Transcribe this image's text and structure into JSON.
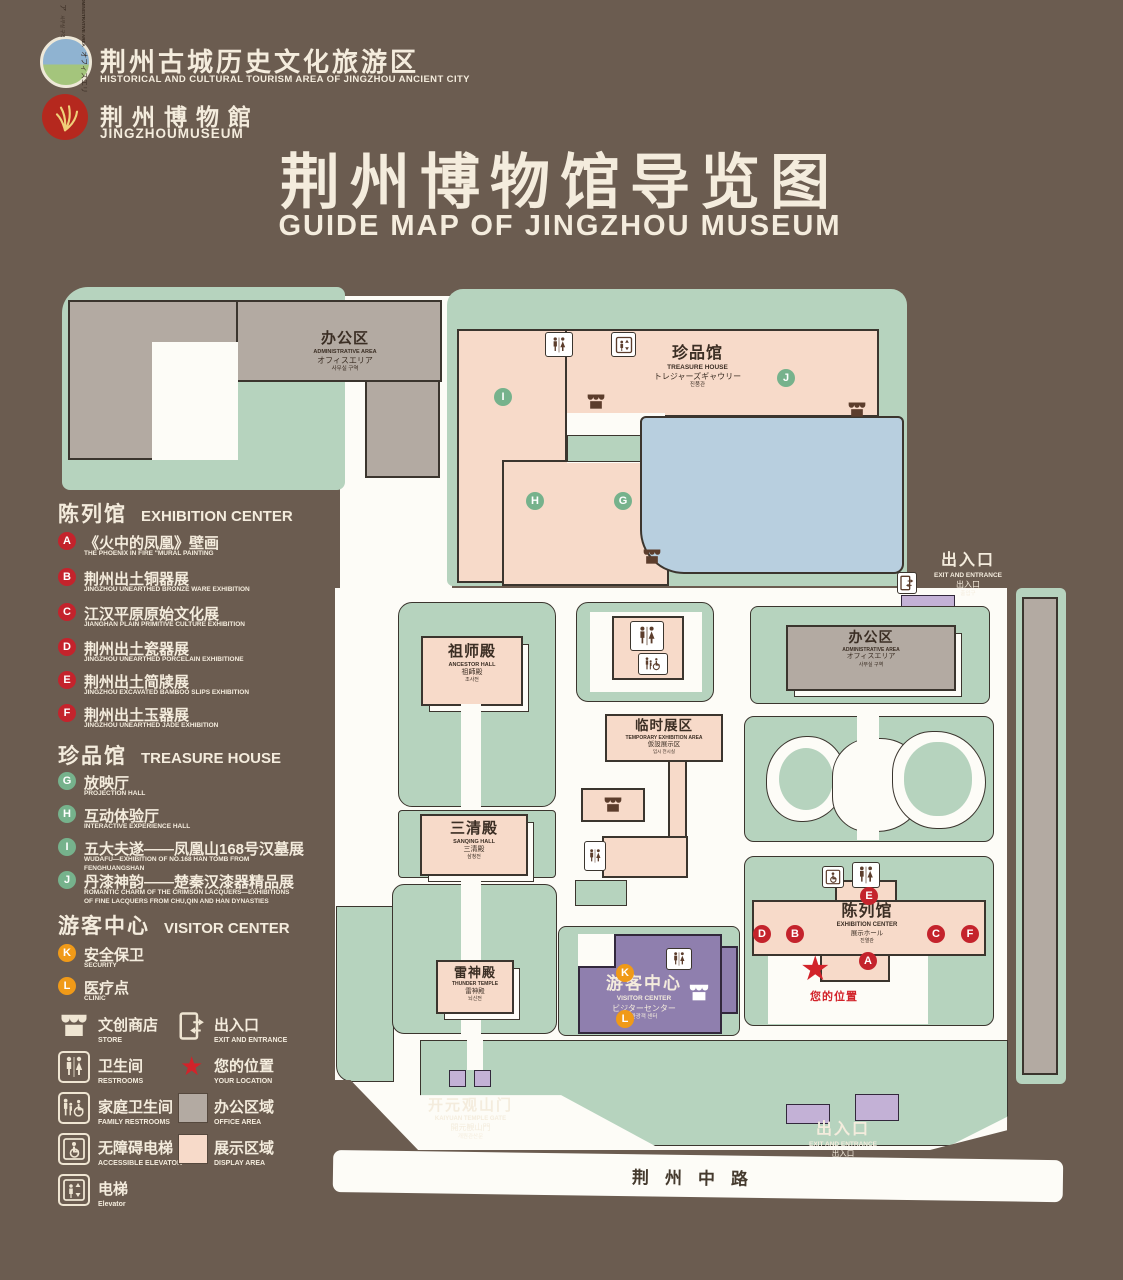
{
  "header": {
    "org": {
      "title": "荆州古城历史文化旅游区",
      "subtitle": "HISTORICAL AND CULTURAL TOURISM AREA OF JINGZHOU ANCIENT CITY"
    },
    "museum": {
      "title": "荆州博物館",
      "subtitle": "JINGZHOUMUSEUM"
    },
    "title": "荆州博物馆导览图",
    "subtitle": "GUIDE MAP OF JINGZHOU MUSEUM"
  },
  "legend": {
    "exhibition": {
      "cn": "陈列馆",
      "en": "EXHIBITION CENTER",
      "items": [
        {
          "id": "A",
          "cn": "《火中的凤凰》壁画",
          "en": "THE PHOENIX IN FIRE \"MURAL PAINTING",
          "floor": "1F"
        },
        {
          "id": "B",
          "cn": "荆州出土铜器展",
          "en": "JINGZHOU UNEARTHED BRONZE WARE EXHIBITION",
          "floor": "1F"
        },
        {
          "id": "C",
          "cn": "江汉平原原始文化展",
          "en": "JIANGHAN PLAIN PRIMITIVE CULTURE EXHIBITION",
          "floor": "1F"
        },
        {
          "id": "D",
          "cn": "荆州出土瓷器展",
          "en": "JINGZHOU UNEARTHED PORCELAIN EXHIBITIONE",
          "floor": "2F"
        },
        {
          "id": "E",
          "cn": "荆州出土简牍展",
          "en": "JINGZHOU EXCAVATED BAMBOO SLIPS EXHIBITION",
          "floor": "2F"
        },
        {
          "id": "F",
          "cn": "荆州出土玉器展",
          "en": "JINGZHOU UNEARTHED JADE EXHIBITION",
          "floor": "2F"
        }
      ]
    },
    "treasure": {
      "cn": "珍品馆",
      "en": "TREASURE HOUSE",
      "items": [
        {
          "id": "G",
          "cn": "放映厅",
          "en": "PROJECTION HALL",
          "floor": "1F"
        },
        {
          "id": "H",
          "cn": "互动体验厅",
          "en": "INTERACTIVE EXPERIENCE HALL",
          "floor": "1F"
        },
        {
          "id": "I",
          "cn": "五大夫遂——凤凰山168号汉墓展",
          "en": "WUDAFU—EXHIBITION OF NO.168 HAN TOMB FROM FENGHUANGSHAN",
          "floor": "2F"
        },
        {
          "id": "J",
          "cn": "丹漆神韵——楚秦汉漆器精品展",
          "en": "ROMANTIC CHARM OF THE CRIMSON LACQUERS—EXHIBITIONS OF FINE LACQUERS FROM CHU,QIN AND HAN DYNASTIES",
          "floor": "1-2F"
        }
      ]
    },
    "visitor": {
      "cn": "游客中心",
      "en": "VISITOR CENTER",
      "items": [
        {
          "id": "K",
          "cn": "安全保卫",
          "en": "SECURITY",
          "floor": "1F"
        },
        {
          "id": "L",
          "cn": "医疗点",
          "en": "CLINIC",
          "floor": "1F"
        }
      ]
    },
    "symbols": [
      {
        "icon": "store-icon",
        "cn": "文创商店",
        "en": "STORE"
      },
      {
        "icon": "exit-icon",
        "cn": "出入口",
        "en": "EXIT AND ENTRANCE"
      },
      {
        "icon": "restroom-icon",
        "cn": "卫生间",
        "en": "RESTROOMS"
      },
      {
        "icon": "location-icon",
        "cn": "您的位置",
        "en": "YOUR LOCATION"
      },
      {
        "icon": "family-restroom-icon",
        "cn": "家庭卫生间",
        "en": "FAMILY RESTROOMS"
      },
      {
        "icon": "office-swatch",
        "cn": "办公区域",
        "en": "OFFICE AREA"
      },
      {
        "icon": "accessible-elevator-icon",
        "cn": "无障碍电梯",
        "en": "ACCESSIBLE ELEVATOR"
      },
      {
        "icon": "display-swatch",
        "cn": "展示区域",
        "en": "DISPLAY AREA"
      },
      {
        "icon": "elevator-icon",
        "cn": "电梯",
        "en": "Elevator"
      }
    ]
  },
  "map": {
    "admin_nw": {
      "cn": "办公区",
      "en": "ADMINISTRATIVE AREA",
      "jp": "オフィスエリア",
      "kr": "사무실 구역"
    },
    "treasure_house": {
      "cn": "珍品馆",
      "en": "TREASURE HOUSE",
      "jp": "トレジャーズギャウリー",
      "kr": "진품관"
    },
    "exit_ne": {
      "cn": "出入口",
      "en": "EXIT AND ENTRANCE",
      "jp": "出入口",
      "kr": "출입구"
    },
    "admin_e": {
      "cn": "办公区",
      "en": "ADMINISTRATIVE AREA",
      "jp": "オフィスエリア",
      "kr": "사무실 구역"
    },
    "admin_strip": {
      "cn": "办公区",
      "en": "ADMINISTRATIVE AREA",
      "jp": "オフィスエリア",
      "kr": "사무실 구역"
    },
    "ancestor_hall": {
      "cn": "祖师殿",
      "en": "ANCESTOR HALL",
      "jp": "祖師殿",
      "kr": "조사전"
    },
    "sanqing_hall": {
      "cn": "三清殿",
      "en": "SANQING HALL",
      "jp": "三清殿",
      "kr": "삼청전"
    },
    "temporary_area": {
      "cn": "临时展区",
      "en": "TEMPORARY EXHIBITION AREA",
      "jp": "仮設展示区",
      "kr": "임시 전시실"
    },
    "exhibition_center": {
      "cn": "陈列馆",
      "en": "EXHIBITION CENTER",
      "jp": "展示ホール",
      "kr": "진열관"
    },
    "thunder_temple": {
      "cn": "雷神殿",
      "en": "THUNDER TEMPLE",
      "jp": "雷神殿",
      "kr": "뇌신전"
    },
    "visitor_center": {
      "cn": "游客中心",
      "en": "VISITOR CENTER",
      "jp": "ビジターセンター",
      "kr": "관광객 센터"
    },
    "gate": {
      "cn": "开元观山门",
      "en": "KAIYUAN TEMPLE GATE",
      "jp": "開元観山門",
      "kr": "개원관산문"
    },
    "exit_s": {
      "cn": "出入口",
      "en": "EXIT AND ENTRANCE",
      "jp": "出入口",
      "kr": "출입구"
    },
    "road": "荆州中路",
    "your_location": "您的位置",
    "markers": {
      "A": "A",
      "B": "B",
      "C": "C",
      "D": "D",
      "E": "E",
      "F": "F",
      "G": "G",
      "H": "H",
      "I": "I",
      "J": "J",
      "K": "K",
      "L": "L"
    }
  },
  "colors": {
    "background": "#6b5c50",
    "ground_green": "#b6d3be",
    "display_pink": "#f7dac9",
    "office_gray": "#b3aaa2",
    "lake_blue": "#b8cfdf",
    "visitor_purple": "#8f7fae",
    "gate_purple": "#c3b1d6",
    "marker_red": "#c4232c",
    "marker_green": "#76b28c",
    "marker_orange": "#f09a18",
    "road_white": "#fdfcf7",
    "text_cream": "#f4ecdd"
  }
}
